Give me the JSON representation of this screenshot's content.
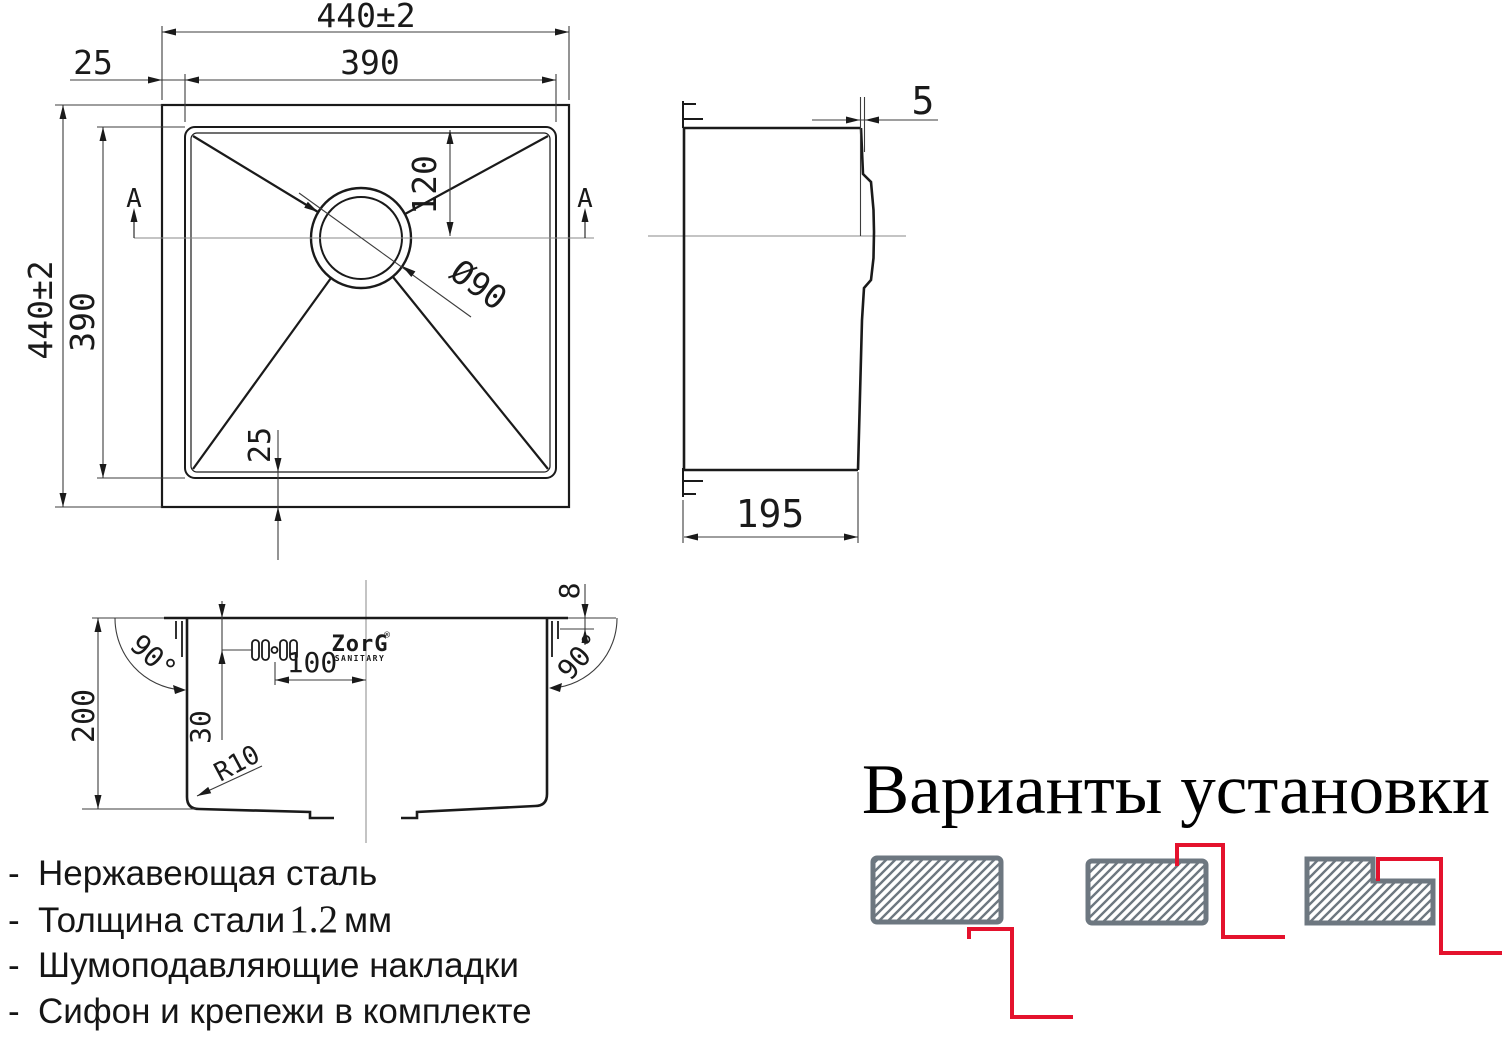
{
  "dims": {
    "outer_width": "440±2",
    "inner_width": "390",
    "rim_offset": "25",
    "outer_height": "440±2",
    "inner_height": "390",
    "bottom_offset": "25",
    "drain_offset_top": "120",
    "drain_diameter": "Ø90",
    "section_marker": "A",
    "rim_thickness": "5",
    "depth": "195",
    "bowl_depth": "200",
    "overflow_from_rim": "30",
    "overflow_to_center": "100",
    "bottom_radius": "R10",
    "rim_lip": "8",
    "wall_angle": "90°"
  },
  "brand": {
    "name": "ZorG",
    "trademark": "®",
    "subtitle": "SANITARY"
  },
  "features": {
    "bullet": "-",
    "line1": "Нержавеющая сталь",
    "line2_prefix": "Толщина стали",
    "line2_value": "1.2",
    "line2_suffix": "мм",
    "line3": "Шумоподавляющие накладки",
    "line4": "Сифон и крепежи в комплекте"
  },
  "install": {
    "title": "Варианты установки",
    "variants": [
      "undermount",
      "overmount",
      "flush-mount"
    ]
  },
  "colors": {
    "line": "#1a1a1a",
    "thin_line": "#3c3c3c",
    "centerline": "#8a8a8a",
    "counter_gray": "#6d7780",
    "accent_red": "#e4122d"
  }
}
